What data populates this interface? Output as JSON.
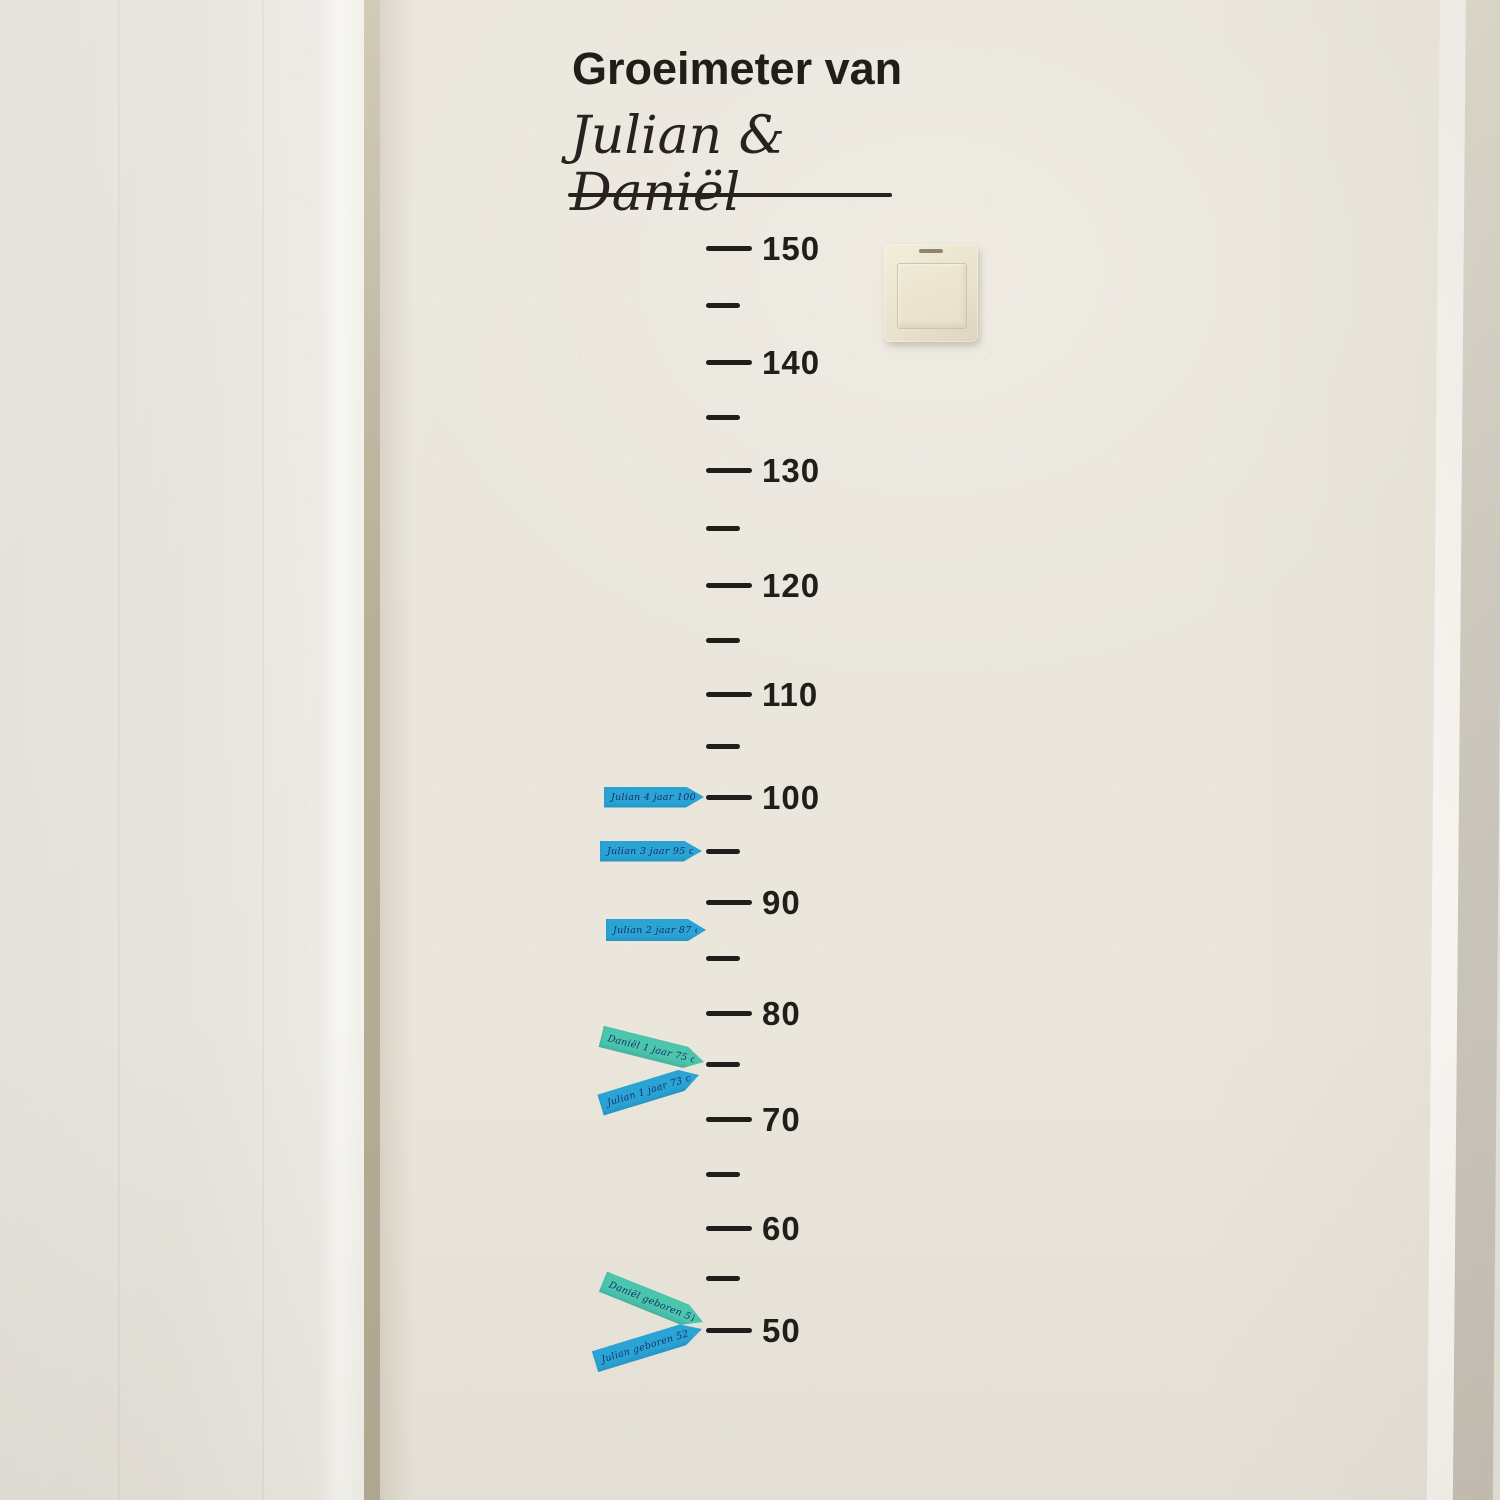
{
  "decal": {
    "title": "Groeimeter van",
    "names": "Julian & Daniël"
  },
  "ruler": {
    "unit": "cm",
    "major_ticks": [
      {
        "cm": 150,
        "label": "150"
      },
      {
        "cm": 140,
        "label": "140"
      },
      {
        "cm": 130,
        "label": "130"
      },
      {
        "cm": 120,
        "label": "120"
      },
      {
        "cm": 110,
        "label": "110"
      },
      {
        "cm": 100,
        "label": "100"
      },
      {
        "cm": 90,
        "label": "90"
      },
      {
        "cm": 80,
        "label": "80"
      },
      {
        "cm": 70,
        "label": "70"
      },
      {
        "cm": 60,
        "label": "60"
      },
      {
        "cm": 50,
        "label": "50"
      }
    ],
    "minor_ticks_cm": [
      145,
      135,
      125,
      115,
      105,
      95,
      85,
      75,
      65,
      55
    ]
  },
  "markers": [
    {
      "id": "julian-4-jaar",
      "text": "Julian 4 jaar 100 cm",
      "cm": 100,
      "color": "#2aa4d5"
    },
    {
      "id": "julian-3-jaar",
      "text": "Julian 3 jaar 95 cm",
      "cm": 95,
      "color": "#2aa4d5"
    },
    {
      "id": "julian-2-jaar",
      "text": "Julian 2 jaar 87 cm",
      "cm": 87,
      "color": "#2aa4d5"
    },
    {
      "id": "daniel-1-jaar",
      "text": "Daniël 1 jaar 75 cm",
      "cm": 75,
      "color": "#4cc5ad"
    },
    {
      "id": "julian-1-jaar",
      "text": "Julian 1 jaar 73 cm",
      "cm": 75,
      "color": "#2aa4d5"
    },
    {
      "id": "daniel-geboren",
      "text": "Daniël geboren 51 cm",
      "cm": 50,
      "color": "#4cc5ad"
    },
    {
      "id": "julian-geboren",
      "text": "Julian geboren 52 cm",
      "cm": 50,
      "color": "#2aa4d5"
    }
  ],
  "colors": {
    "wall": "#eae6dc",
    "decal_black": "#211d1a",
    "arrow_blue": "#2aa4d5",
    "arrow_teal": "#4cc5ad",
    "handwriting_ink": "#17306a",
    "switch_plate": "#ece5d1"
  }
}
